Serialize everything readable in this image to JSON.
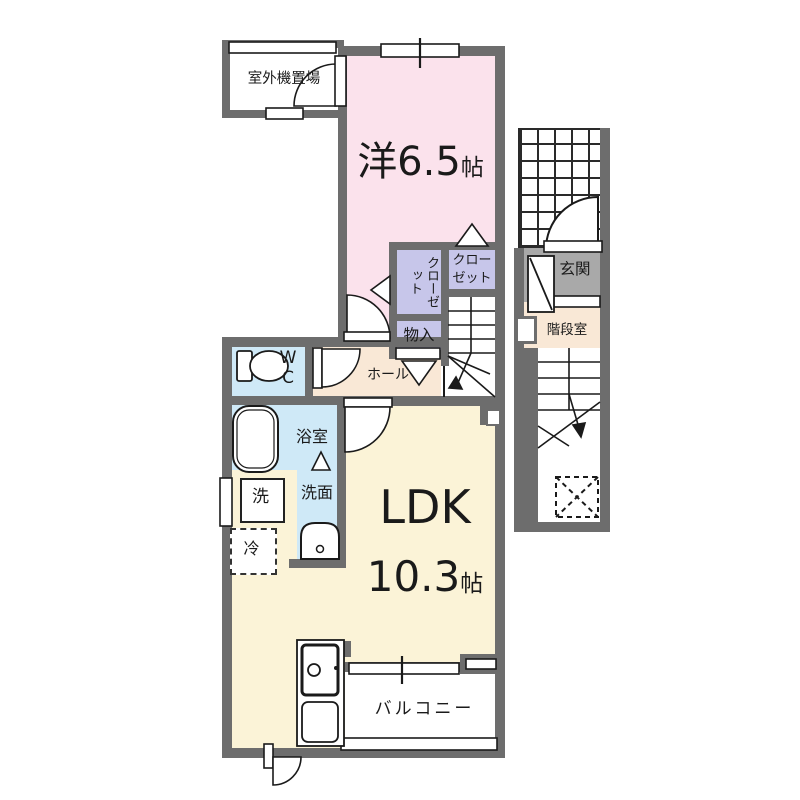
{
  "plan_type": "floor-plan",
  "colors": {
    "wall": "#6d6d6d",
    "western_room": "#fbe2ec",
    "hall_stair_room": "#f9e8d6",
    "ldk": "#fbf3d7",
    "wet_rooms": "#cfe9f7",
    "closets": "#c7c6ea",
    "entrance": "#a9a9a9",
    "line": "#1a1a1a"
  },
  "rooms": {
    "outdoor_unit": {
      "label": "室外機置場"
    },
    "western_room": {
      "label": "洋6.5",
      "unit": "帖"
    },
    "closet_left": {
      "label": "クローゼット"
    },
    "closet_right": {
      "label": "クローゼット"
    },
    "storage": {
      "label": "物入"
    },
    "hall": {
      "label": "ホール"
    },
    "wc": {
      "label": "WC"
    },
    "bathroom": {
      "label": "浴室"
    },
    "laundry": {
      "label": "洗"
    },
    "washroom": {
      "label": "洗面"
    },
    "refrigerator": {
      "label": "冷"
    },
    "ldk": {
      "label": "LDK",
      "size": "10.3",
      "unit": "帖"
    },
    "balcony": {
      "label": "バルコニー"
    },
    "entrance": {
      "label": "玄関"
    },
    "stair_room": {
      "label": "階段室"
    }
  }
}
